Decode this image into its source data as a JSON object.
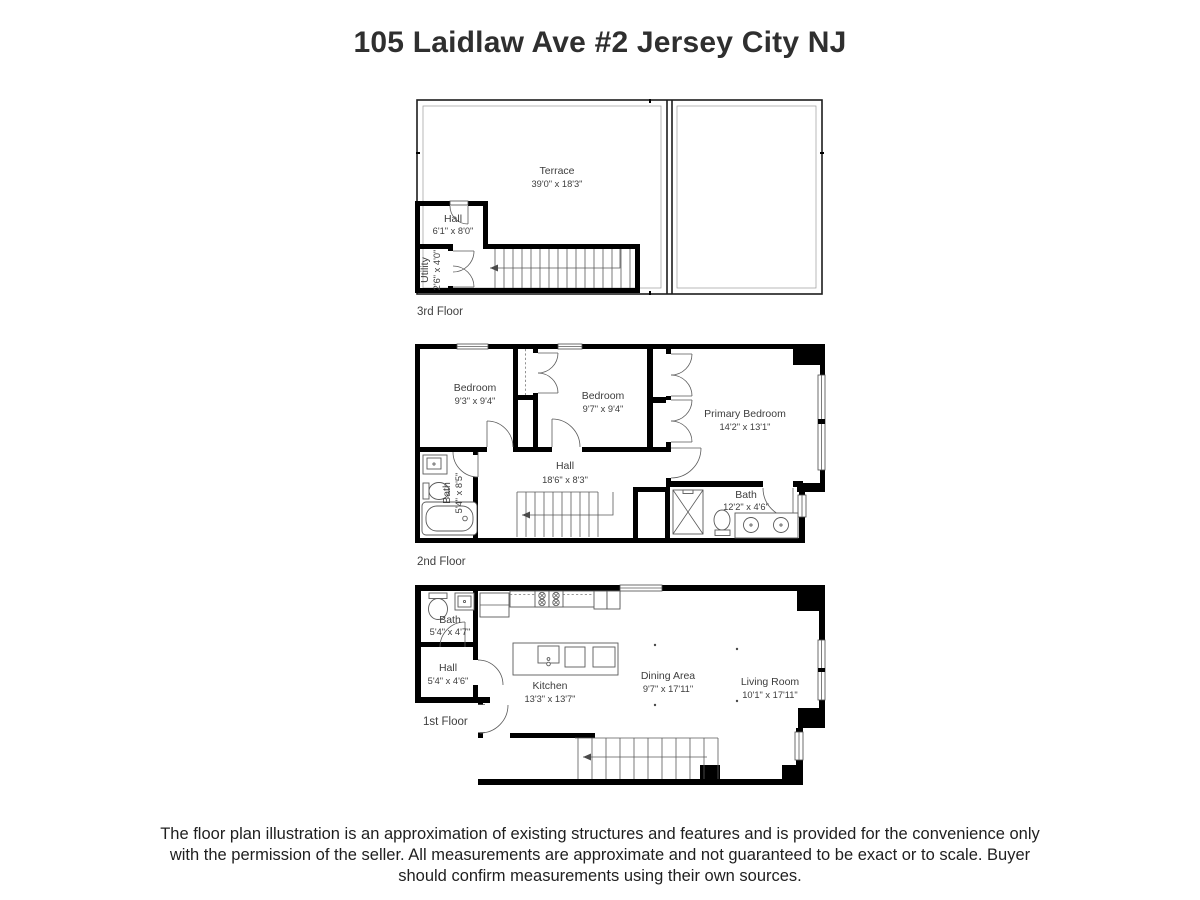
{
  "page_title": "105 Laidlaw Ave #2 Jersey City NJ",
  "floors": {
    "third": {
      "caption": "3rd Floor",
      "rooms": {
        "terrace": {
          "name": "Terrace",
          "dims": "39'0\" x 18'3\""
        },
        "hall": {
          "name": "Hall",
          "dims": "6'1\" x 8'0\""
        },
        "utility": {
          "name": "Utility",
          "dims": "2'6\" x 4'0\""
        }
      }
    },
    "second": {
      "caption": "2nd Floor",
      "rooms": {
        "bedroom_left": {
          "name": "Bedroom",
          "dims": "9'3\" x 9'4\""
        },
        "bedroom_mid": {
          "name": "Bedroom",
          "dims": "9'7\" x 9'4\""
        },
        "primary_bedroom": {
          "name": "Primary Bedroom",
          "dims": "14'2\" x 13'1\""
        },
        "hall": {
          "name": "Hall",
          "dims": "18'6\" x 8'3\""
        },
        "bath_left": {
          "name": "Bath",
          "dims": "5'4\" x 8'5\""
        },
        "bath_right": {
          "name": "Bath",
          "dims": "12'2\" x 4'6\""
        }
      }
    },
    "first": {
      "caption": "1st Floor",
      "rooms": {
        "bath": {
          "name": "Bath",
          "dims": "5'4\" x 4'7\""
        },
        "hall": {
          "name": "Hall",
          "dims": "5'4\" x 4'6\""
        },
        "kitchen": {
          "name": "Kitchen",
          "dims": "13'3\" x 13'7\""
        },
        "dining": {
          "name": "Dining Area",
          "dims": "9'7\" x 17'11\""
        },
        "living": {
          "name": "Living Room",
          "dims": "10'1\" x 17'11\""
        }
      }
    }
  },
  "disclaimer": "The floor plan illustration is an approximation of existing structures and features and is provided for the convenience only with the permission of the seller. All measurements are approximate and not guaranteed to be exact or to scale. Buyer should confirm measurements using their own sources.",
  "colors": {
    "wall": "#000000",
    "label_text": "#3d3d3d",
    "title_text": "#2f2f2f"
  }
}
